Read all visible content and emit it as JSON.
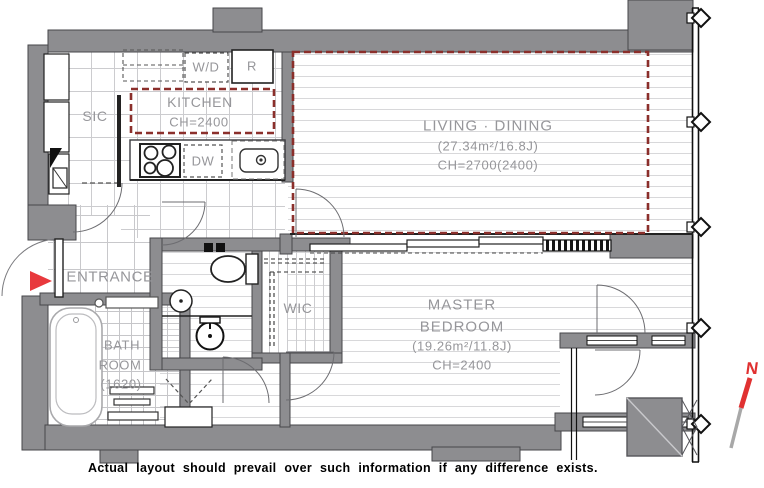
{
  "rooms": {
    "living_dining": {
      "name": "LIVING · DINING",
      "area": "(27.34m²/16.8J)",
      "ceiling": "CH=2700(2400)"
    },
    "master_bedroom": {
      "name_line1": "MASTER",
      "name_line2": "BEDROOM",
      "area": "(19.26m²/11.8J)",
      "ceiling": "CH=2400"
    },
    "kitchen": {
      "name": "KITCHEN",
      "ceiling": "CH=2400"
    },
    "entrance": {
      "name": "ENTRANCE"
    },
    "sic": {
      "name": "SIC"
    },
    "wic": {
      "name": "WIC"
    },
    "bathroom": {
      "name_line1": "BATH",
      "name_line2": "ROOM",
      "size": "(1620)"
    }
  },
  "appliances": {
    "washer_dryer": "W/D",
    "refrigerator": "R",
    "dishwasher": "DW"
  },
  "compass": {
    "north_label": "N"
  },
  "footnote": "Actual layout should prevail over such information if any difference exists.",
  "colors": {
    "wall": "#8d8d90",
    "zone_outline": "#8b2f2b",
    "entrance_marker": "#e8393d",
    "label_gray": "#96969a",
    "compass_red": "#e03131",
    "compass_gray": "#a8a8a8"
  }
}
